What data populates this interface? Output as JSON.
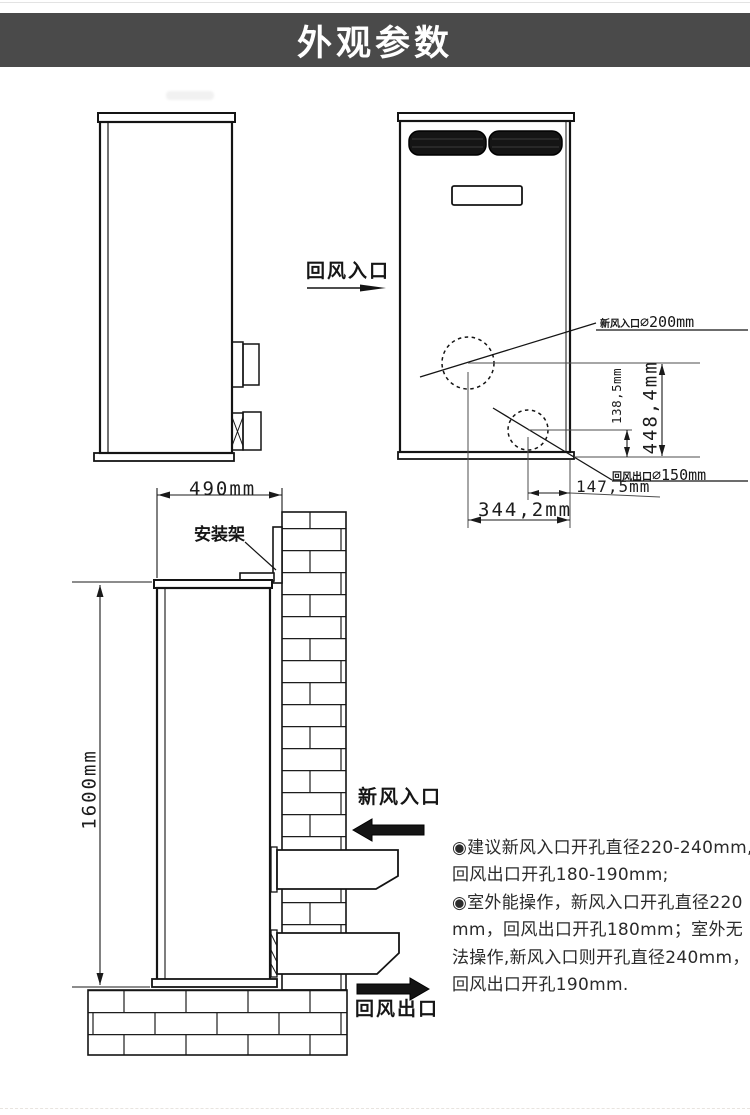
{
  "header": {
    "title": "外观参数"
  },
  "colors": {
    "header_bg": "#4a4a4a",
    "header_fg": "#ffffff",
    "line": "#141414",
    "note_text": "#2b2b2b"
  },
  "front_view": {
    "return_air_inlet_label": "回风入口",
    "fresh_air_hole": {
      "prefix": "新风入口",
      "value": "⌀200mm"
    },
    "return_air_hole": {
      "prefix": "回风出口",
      "value": "⌀150mm"
    },
    "dims": {
      "v_small": "138,5mm",
      "v_large": "448,4mm",
      "h_small": "147,5mm",
      "h_large": "344,2mm"
    }
  },
  "install_view": {
    "width_dim": "490mm",
    "height_dim": "1600mm",
    "bracket_label": "安装架",
    "fresh_air_label": "新风入口",
    "return_air_label": "回风出口"
  },
  "notes": {
    "lines": [
      "◉建议新风入口开孔直径220-240mm,",
      "回风出口开孔180-190mm;",
      "◉室外能操作，新风入口开孔直径220",
      "mm，回风出口开孔180mm；室外无",
      "法操作,新风入口则开孔直径240mm，",
      "回风出口开孔190mm."
    ]
  }
}
